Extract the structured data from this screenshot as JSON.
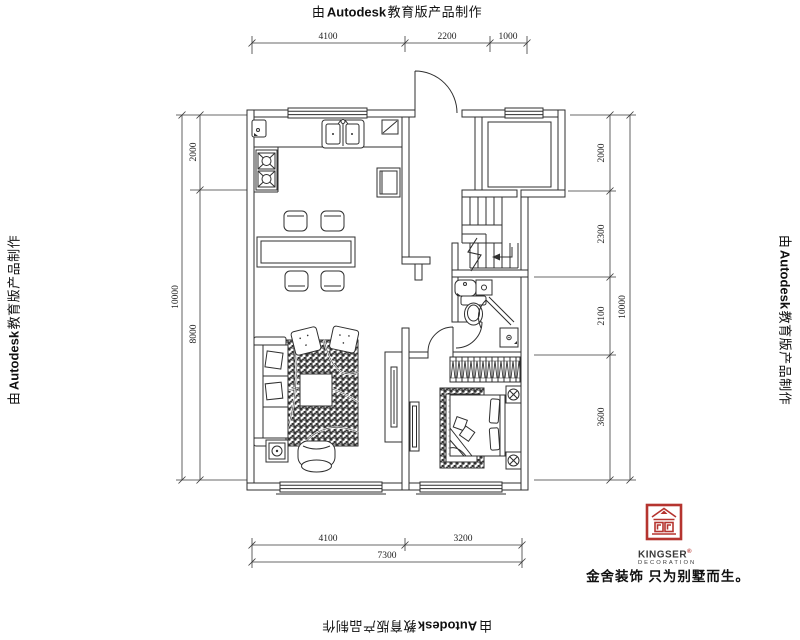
{
  "watermark": {
    "prefix": "由",
    "brand": "Autodesk",
    "suffix": "教育版产品制作"
  },
  "dims": {
    "top": [
      "4100",
      "2200",
      "1000"
    ],
    "bottom_inner": [
      "4100",
      "3200"
    ],
    "bottom_total": "7300",
    "left_inner": [
      "2000",
      "8000"
    ],
    "left_total": "10000",
    "right_inner": [
      "2000",
      "2300",
      "2100",
      "3600"
    ],
    "right_total": "10000"
  },
  "brand": {
    "name": "KINGSER",
    "registered": "®",
    "subtitle": "DECORATION",
    "tagline": "金舍装饰 只为别墅而生。",
    "color": "#b5342f"
  },
  "colors": {
    "line": "#2f2f2f",
    "dim_line": "#3a3a3a",
    "brand_red": "#b5342f"
  }
}
